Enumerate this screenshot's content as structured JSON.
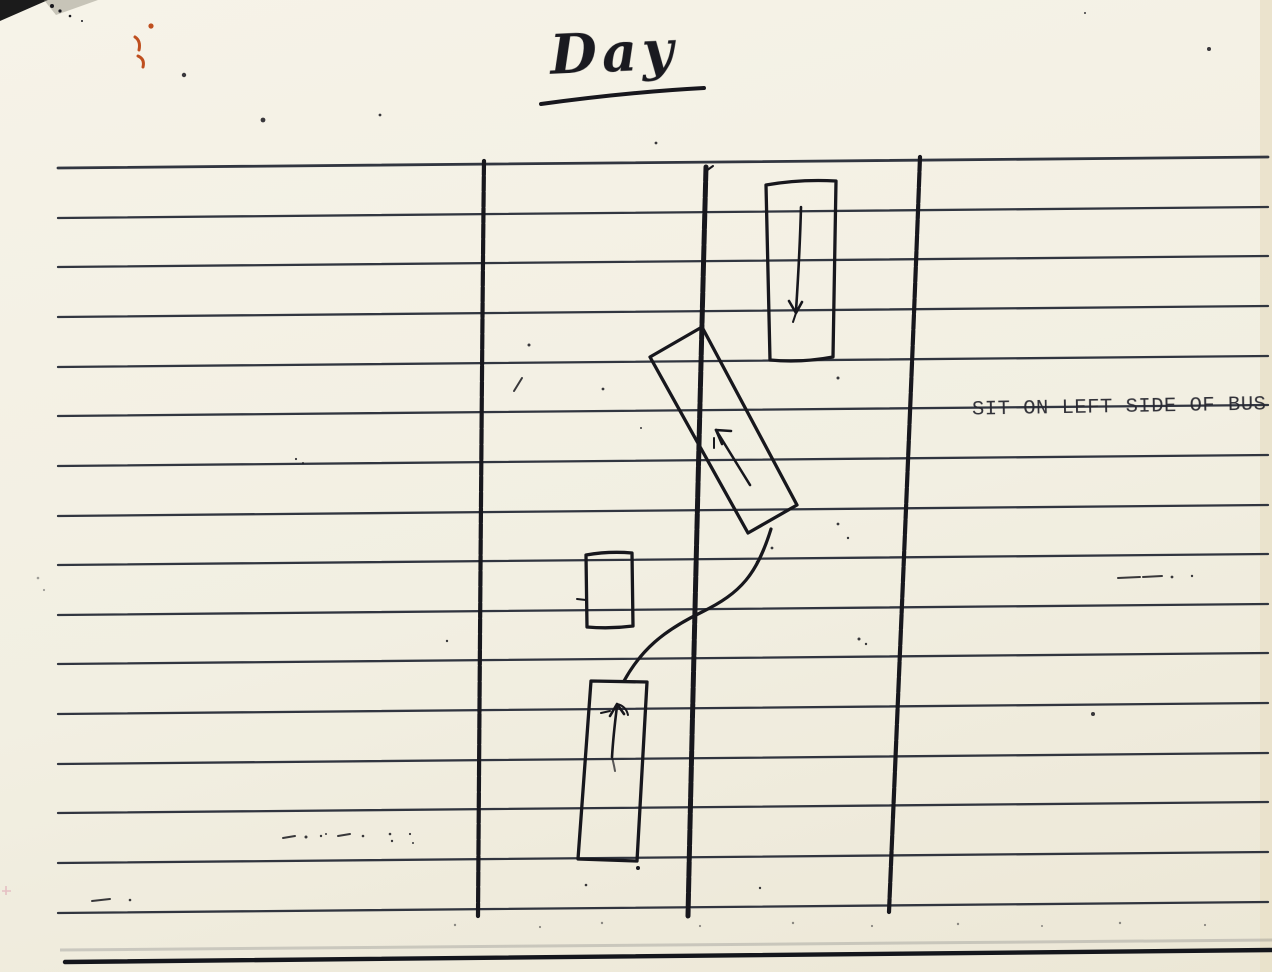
{
  "title": {
    "text": "Day"
  },
  "annotation": {
    "text": "SIT ON LEFT SIDE OF BUS"
  },
  "colors": {
    "paper": "#f2efe2",
    "ink": "#17171d",
    "rule": "#232834",
    "red": "#bf4f1f"
  },
  "diagram": {
    "type": "hand-drawn lane sketch on ruled notebook paper",
    "lane_lines": 3,
    "vehicles": [
      {
        "id": "bus-top-right",
        "arrow": "down"
      },
      {
        "id": "tilted-vehicle-center",
        "arrow": "up-left"
      },
      {
        "id": "small-box-left",
        "arrow": "none"
      },
      {
        "id": "bottom-vehicle",
        "arrow": "up"
      }
    ],
    "travel_path": "s-curve from bottom vehicle across center line up to tilted vehicle"
  }
}
